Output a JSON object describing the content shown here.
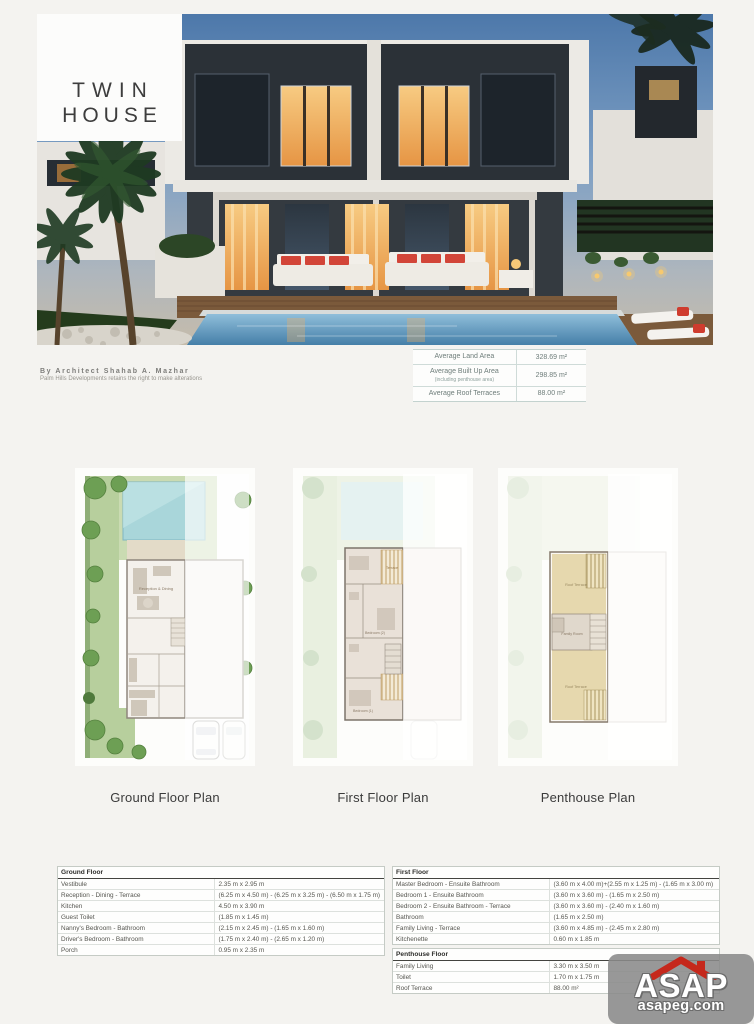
{
  "header": {
    "title_line1": "TWIN",
    "title_line2": "HOUSE"
  },
  "credit": {
    "architect": "By Architect Shahab A. Mazhar",
    "disclaimer": "Palm Hills Developments retains the right to make alterations"
  },
  "area_summary": {
    "rows": [
      {
        "label": "Average Land Area",
        "sub": "",
        "value": "328.69 m²"
      },
      {
        "label": "Average Built Up Area",
        "sub": "(including penthouse area)",
        "value": "298.85 m²"
      },
      {
        "label": "Average Roof Terraces",
        "sub": "",
        "value": "88.00 m²"
      }
    ]
  },
  "plans": {
    "ground": {
      "caption": "Ground Floor Plan",
      "labels": {
        "reception": "Reception & Dining"
      }
    },
    "first": {
      "caption": "First Floor Plan",
      "labels": {
        "terrace": "Terrace",
        "bedroom2": "Bedroom (2)",
        "bedroom1": "Bedroom (1)"
      }
    },
    "penthouse": {
      "caption": "Penthouse Plan",
      "labels": {
        "roof_terrace_top": "Roof Terrace",
        "family_room": "Family Room",
        "roof_terrace_bottom": "Roof Terrace"
      }
    }
  },
  "dimension_tables": {
    "ground": {
      "header": "Ground Floor",
      "rows": [
        {
          "label": "Vestibule",
          "value": "2.35 m x 2.95 m"
        },
        {
          "label": "Reception - Dining - Terrace",
          "value": "(6.25 m x 4.50 m) - (6.25 m x 3.25 m) - (6.50 m x 1.75 m)"
        },
        {
          "label": "Kitchen",
          "value": "4.50 m x 3.90 m"
        },
        {
          "label": "Guest Toilet",
          "value": "(1.85 m x 1.45 m)"
        },
        {
          "label": "Nanny's Bedroom - Bathroom",
          "value": "(2.15 m x 2.45 m) - (1.65 m x 1.60 m)"
        },
        {
          "label": "Driver's Bedroom - Bathroom",
          "value": "(1.75 m x 2.40 m) - (2.65 m x 1.20 m)"
        },
        {
          "label": "Porch",
          "value": "0.95 m x 2.35 m"
        }
      ]
    },
    "first": {
      "header": "First Floor",
      "rows": [
        {
          "label": "Master Bedroom - Ensuite Bathroom",
          "value": "(3.60 m x 4.00 m)+(2.55 m x 1.25 m) - (1.65 m x 3.00 m)"
        },
        {
          "label": "Bedroom 1 - Ensuite Bathroom",
          "value": "(3.60 m x 3.60 m) - (1.65 m x 2.50 m)"
        },
        {
          "label": "Bedroom 2 - Ensuite Bathroom - Terrace",
          "value": "(3.60 m x 3.60 m) - (2.40 m x 1.60 m)"
        },
        {
          "label": "Bathroom",
          "value": "(1.65 m x 2.50 m)"
        },
        {
          "label": "Family Living - Terrace",
          "value": "(3.60 m x 4.85 m) - (2.45 m x 2.80 m)"
        },
        {
          "label": "Kitchenette",
          "value": "0.60 m x 1.85 m"
        }
      ]
    },
    "penthouse": {
      "header": "Penthouse Floor",
      "rows": [
        {
          "label": "Family Living",
          "value": "3.30 m x 3.50 m"
        },
        {
          "label": "Toilet",
          "value": "1.70 m x 1.75 m"
        },
        {
          "label": "Roof Terrace",
          "value": "88.00 m²"
        }
      ]
    }
  },
  "watermark": {
    "name": "ASAP",
    "domain": "asapeg.com"
  },
  "colors": {
    "accent_red": "#c5281c",
    "plan_green": "#b7cf9d",
    "pool_blue": "#a9d6da",
    "terrace_tan": "#e6d8ae"
  }
}
